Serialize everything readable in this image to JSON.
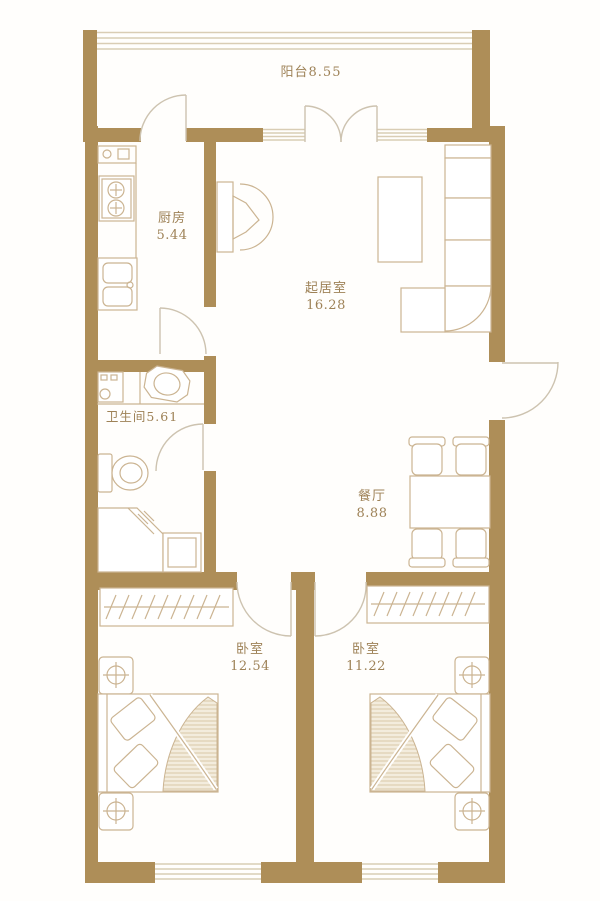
{
  "colors": {
    "wall": "#ae8e58",
    "furn": "#cbb492",
    "window": "#d9cdb4",
    "door": "#cdc3b0",
    "text": "#9e8257",
    "hatch": "#d8c8a8",
    "bg": "#fffefc"
  },
  "rooms": {
    "balcony": {
      "label": "阳台8.55"
    },
    "kitchen": {
      "name": "厨房",
      "area": "5.44"
    },
    "living": {
      "name": "起居室",
      "area": "16.28"
    },
    "bathroom": {
      "label": "卫生间5.61"
    },
    "dining": {
      "name": "餐厅",
      "area": "8.88"
    },
    "bedroom_left": {
      "name": "卧室",
      "area": "12.54"
    },
    "bedroom_right": {
      "name": "卧室",
      "area": "11.22"
    }
  }
}
